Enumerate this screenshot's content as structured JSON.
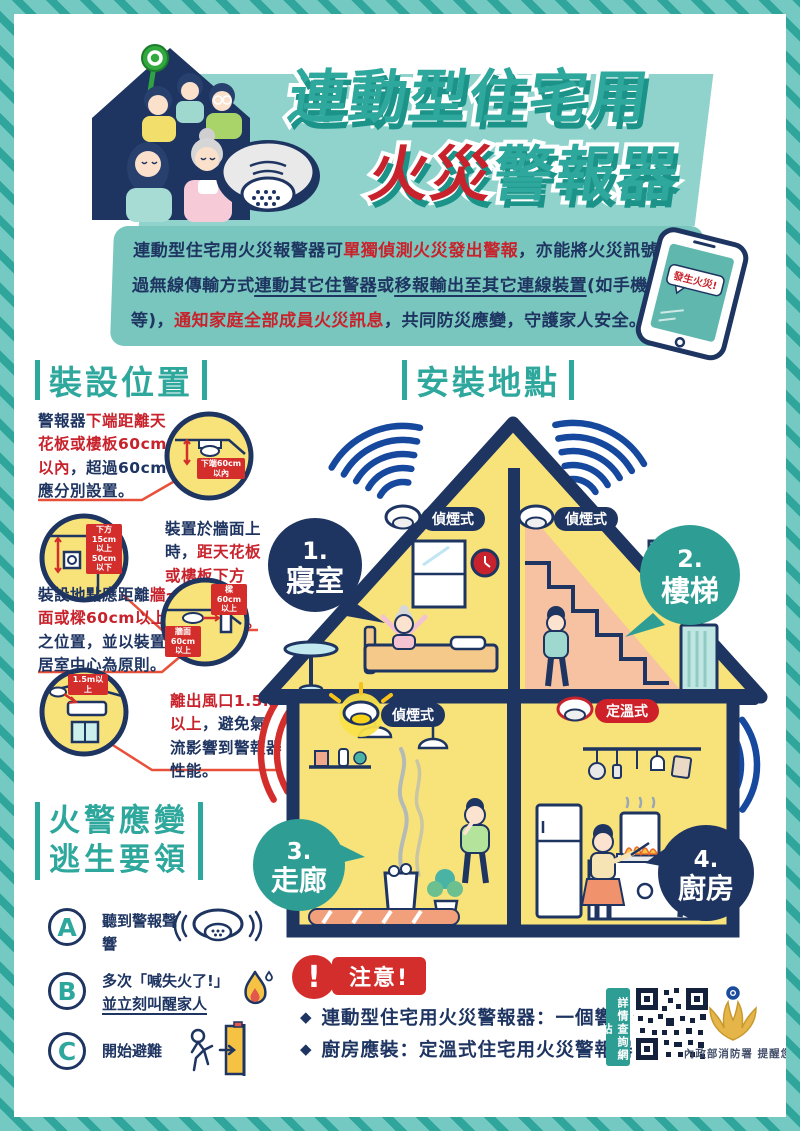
{
  "header": {
    "title_line1": "連動型住宅用",
    "title_line2_red": "火災",
    "title_line2_teal": "警報器",
    "phone_alert": "發生火災!"
  },
  "intro": {
    "s1": "連動型住宅用火災報警器可",
    "s2": "單獨偵測火災發出警報",
    "s3": "，亦能將火災訊號透過無線傳輸方式",
    "s4": "連動其它住警器",
    "s5": "或",
    "s6": "移報輸出至其它連線裝置",
    "s7": "(如手機等)，",
    "s8": "通知家庭全部成員火災訊息",
    "s9": "，共同防災應變，守護家人安全。"
  },
  "install_position": {
    "heading": "裝設位置",
    "items": [
      {
        "pre": "警報器",
        "red": "下端距離天花板或樓板60cm以內",
        "post": "，超過60cm應分別設置。",
        "badge": "下端60cm以內"
      },
      {
        "pre": "裝置於牆面上時，",
        "red": "距天花板或樓板下方15cm以上50cm以下。",
        "post": "",
        "badge": "下方15cm以上50cm以下"
      },
      {
        "pre": "裝設地點應距離",
        "red": "牆面或樑60cm以上",
        "post": "之位置，並以裝置居室中心為原則。",
        "badge": "樑60cm以上",
        "badge2": "牆面60cm以上"
      },
      {
        "pre": "",
        "red": "離出風口1.5m以上",
        "post": "，避免氣流影響到警報器性能。",
        "badge": "1.5m以上"
      }
    ]
  },
  "escape": {
    "heading_line1": "火警應變",
    "heading_line2": "逃生要領",
    "items": [
      {
        "letter": "A",
        "text": "聽到警報聲響"
      },
      {
        "letter": "B",
        "text": "多次「喊失火了!」",
        "text_underline": "並立刻叫醒家人"
      },
      {
        "letter": "C",
        "text": "開始避難"
      }
    ]
  },
  "install_location": {
    "heading": "安裝地點",
    "rooms": [
      {
        "num": "1.",
        "name": "寢室",
        "detector": "偵煙式"
      },
      {
        "num": "2.",
        "name": "樓梯",
        "detector": "偵煙式"
      },
      {
        "num": "3.",
        "name": "走廊",
        "detector": "偵煙式"
      },
      {
        "num": "4.",
        "name": "廚房",
        "detector": "定溫式"
      }
    ]
  },
  "notice": {
    "exclaim": "!",
    "label": "注意!",
    "bullet_marker": "◆",
    "bullet1": "連動型住宅用火災警報器：一個響、全部響",
    "bullet2": "廚房應裝：定溫式住宅用火災警報器",
    "qr_label": "詳情查詢網站",
    "agency": "內政部消防署 提醒您"
  },
  "colors": {
    "teal": "#2ea79d",
    "navy": "#1e3461",
    "red": "#c8232c",
    "room_yellow": "#f8e27a",
    "stairs_peach": "#f6c2a2",
    "frame_teal": "#74cac2"
  }
}
